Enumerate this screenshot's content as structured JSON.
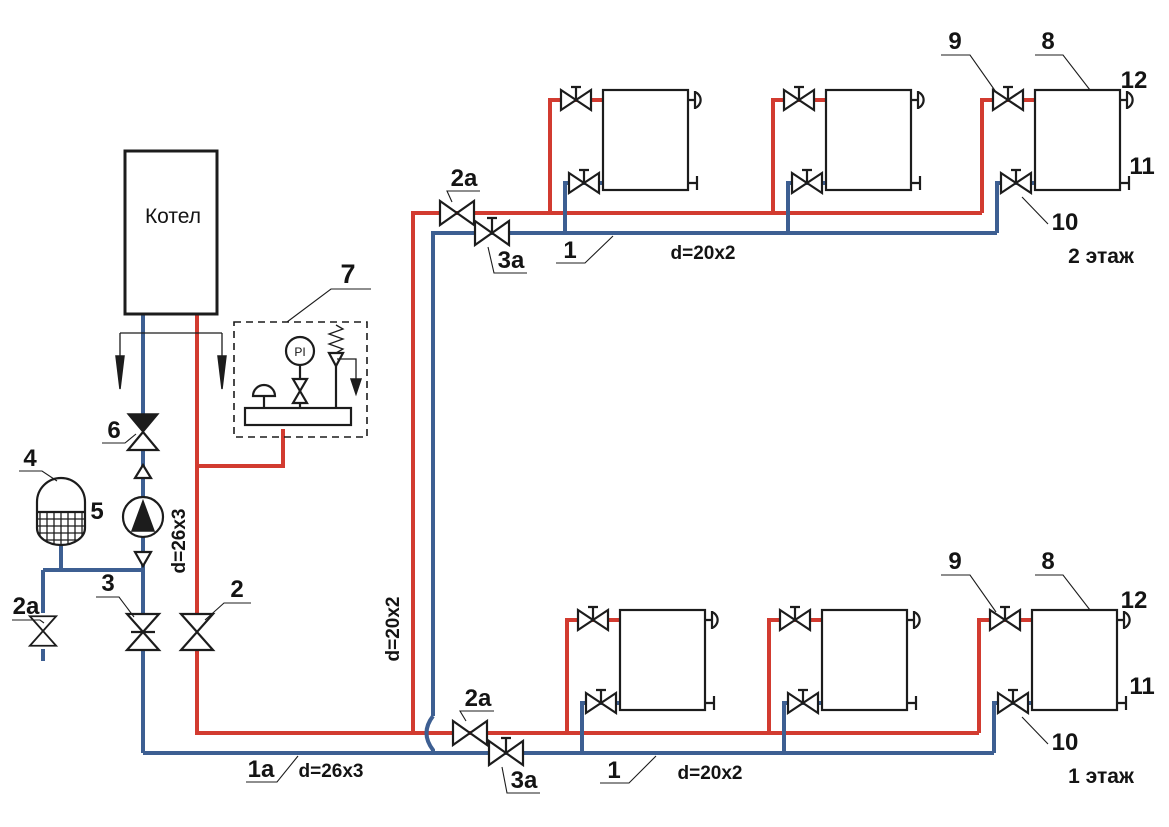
{
  "diagram": {
    "type": "two-floor radiator heating system piping schematic",
    "colors": {
      "supply_pipe": "#d23b30",
      "return_pipe": "#3d5f92",
      "line": "#1c1c1c",
      "background": "#ffffff"
    },
    "labels": {
      "boiler": "Котел",
      "pi": "PI",
      "n1": "1",
      "n1a": "1a",
      "n2": "2",
      "n2a": "2a",
      "n3": "3",
      "n3a": "3a",
      "n4": "4",
      "n5": "5",
      "n6": "6",
      "n7": "7",
      "n8": "8",
      "n9": "9",
      "n10": "10",
      "n11": "11",
      "n12": "12",
      "d26": "d=26x3",
      "d20": "d=20x2",
      "floor2": "2 этаж",
      "floor1": "1 этаж"
    },
    "icons": {
      "boiler": "boiler-box",
      "pump": "circulation-pump-icon",
      "expansion_tank": "expansion-tank-icon",
      "safety_group": "safety-group-icon",
      "pressure_gauge": "pressure-gauge-icon",
      "relief_valve": "relief-valve-icon",
      "air_vent": "air-vent-icon",
      "drain_plug": "drain-plug-icon",
      "radiator": "radiator-icon",
      "valve": "valve-icon",
      "check_valve": "check-valve-icon",
      "flow_arrows": "flow-direction-arrows"
    },
    "radiators_per_floor": "3",
    "floors": "2"
  }
}
